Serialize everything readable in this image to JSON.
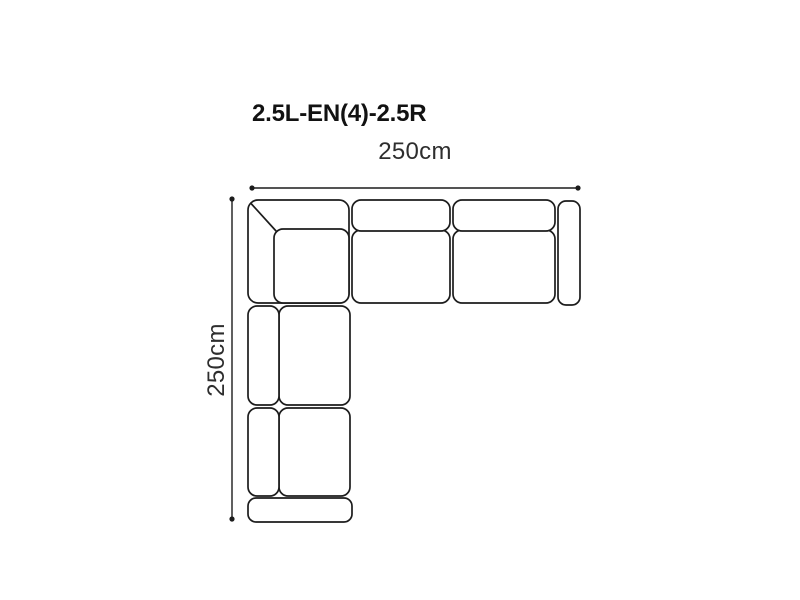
{
  "diagram": {
    "title": "2.5L-EN(4)-2.5R",
    "width_dimension": {
      "label": "250cm",
      "value_cm": 250
    },
    "depth_dimension": {
      "label": "250cm",
      "value_cm": 250
    },
    "colors": {
      "line": "#1c1c1c",
      "label_text": "#2e2e2e",
      "title_text": "#121212",
      "background": "#ffffff",
      "cushion_fill": "#ffffff"
    },
    "parts": [
      "corner-section",
      "middle-seat-section",
      "right-seat-section",
      "right-armrest",
      "upper-left-seat-section",
      "lower-left-seat-section",
      "bottom-armrest"
    ]
  }
}
